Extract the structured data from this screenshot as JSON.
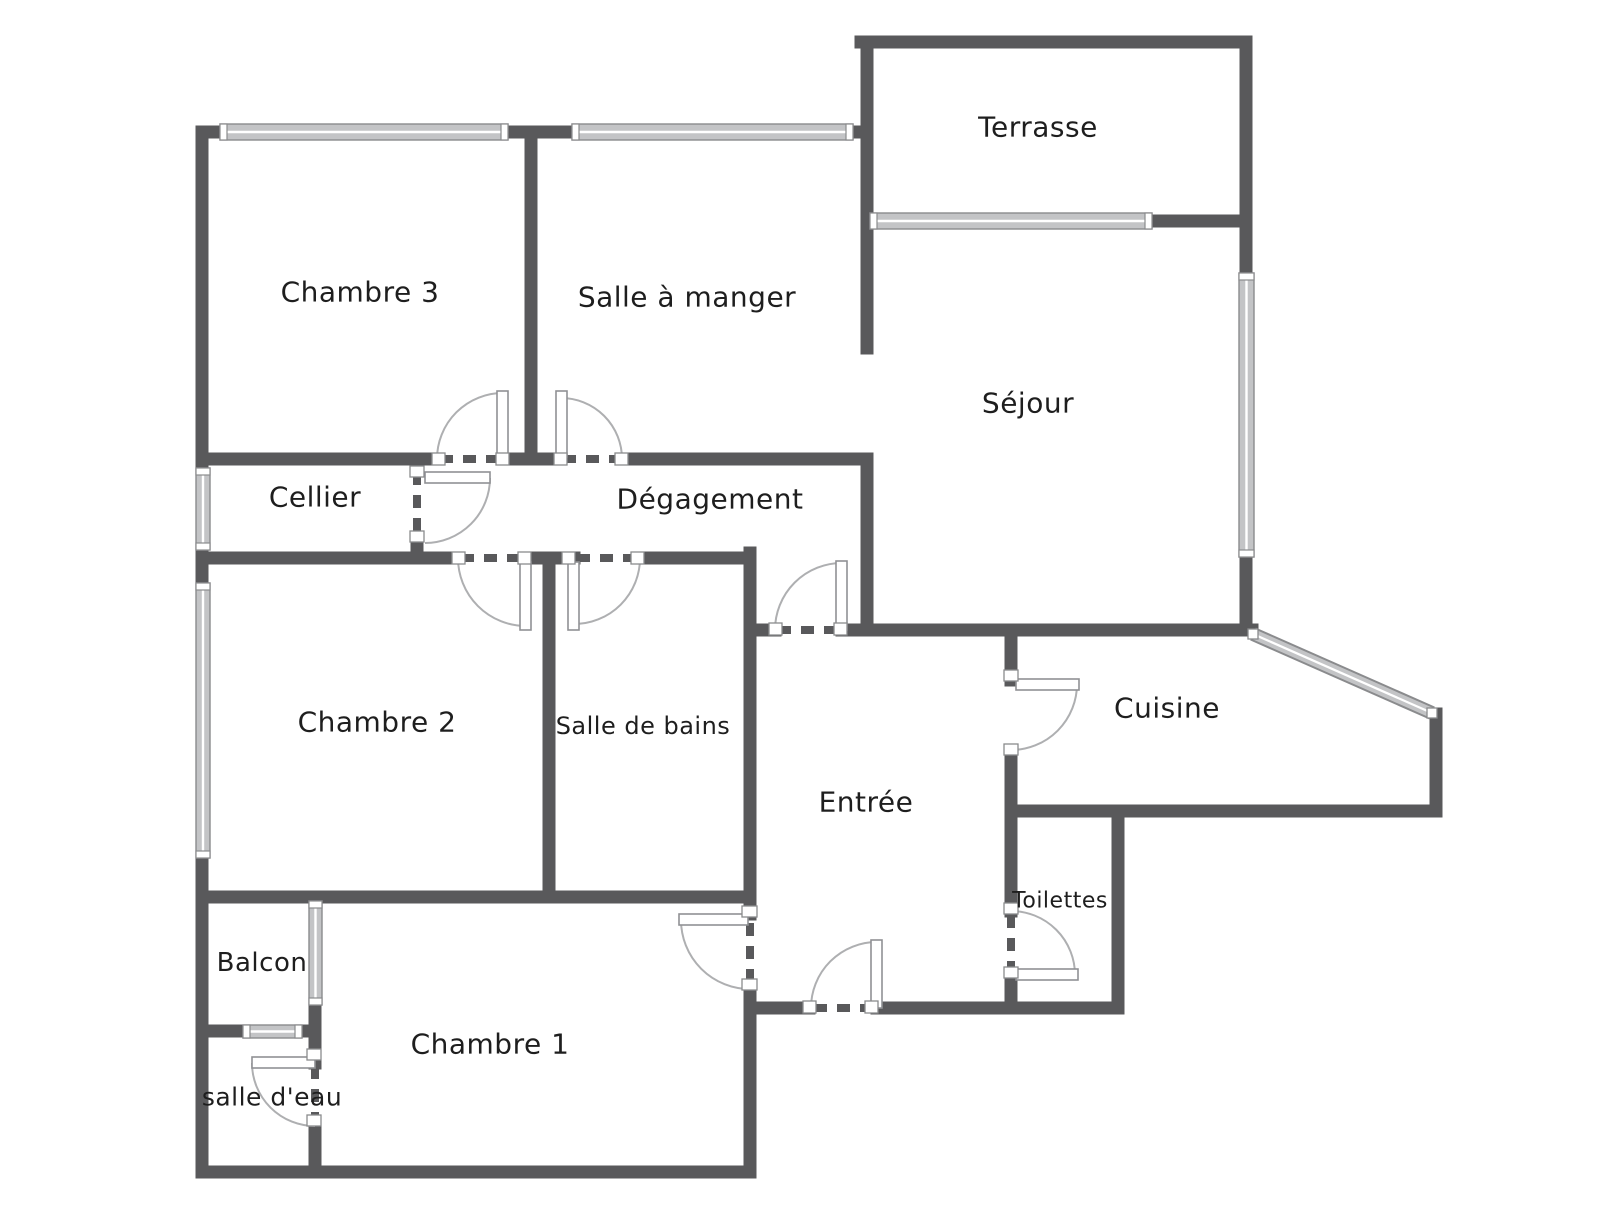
{
  "colors": {
    "background": "#ffffff",
    "wall": "#59595b",
    "window_fill": "#c3c4c6",
    "window_border": "#8a8b8d",
    "leaf_border": "#909194",
    "arc": "#aeafb1",
    "text": "#1e1e1e"
  },
  "rooms": [
    {
      "label": "Terrasse",
      "x": 1038,
      "y": 127,
      "size": 28
    },
    {
      "label": "Chambre 3",
      "x": 360,
      "y": 292,
      "size": 28
    },
    {
      "label": "Salle à manger",
      "x": 687,
      "y": 297,
      "size": 28
    },
    {
      "label": "Séjour",
      "x": 1028,
      "y": 403,
      "size": 28
    },
    {
      "label": "Cellier",
      "x": 315,
      "y": 497,
      "size": 28
    },
    {
      "label": "Dégagement",
      "x": 710,
      "y": 499,
      "size": 28
    },
    {
      "label": "Chambre 2",
      "x": 377,
      "y": 722,
      "size": 28
    },
    {
      "label": "Salle de bains",
      "x": 643,
      "y": 726,
      "size": 24
    },
    {
      "label": "Cuisine",
      "x": 1167,
      "y": 708,
      "size": 28
    },
    {
      "label": "Entrée",
      "x": 866,
      "y": 802,
      "size": 28
    },
    {
      "label": "Toilettes",
      "x": 1060,
      "y": 901,
      "size": 22
    },
    {
      "label": "Balcon",
      "x": 262,
      "y": 963,
      "size": 26
    },
    {
      "label": "Chambre 1",
      "x": 490,
      "y": 1044,
      "size": 28
    },
    {
      "label": "salle d'eau",
      "x": 272,
      "y": 1097,
      "size": 25
    }
  ],
  "floorplan": {
    "wall_thickness": 13,
    "walls": [
      [
        202,
        132,
        202,
        1172
      ],
      [
        202,
        132,
        867,
        132
      ],
      [
        531,
        132,
        531,
        459
      ],
      [
        861,
        42,
        1246,
        42
      ],
      [
        867,
        42,
        867,
        348
      ],
      [
        867,
        221,
        1246,
        221
      ],
      [
        1246,
        42,
        1246,
        630
      ],
      [
        202,
        459,
        437,
        459
      ],
      [
        503,
        459,
        561,
        459
      ],
      [
        622,
        459,
        867,
        459
      ],
      [
        867,
        459,
        867,
        630
      ],
      [
        202,
        558,
        458,
        558
      ],
      [
        526,
        558,
        574,
        558
      ],
      [
        640,
        558,
        750,
        558
      ],
      [
        417,
        545,
        417,
        558
      ],
      [
        549,
        558,
        549,
        897
      ],
      [
        750,
        553,
        750,
        914
      ],
      [
        750,
        989,
        750,
        1172
      ],
      [
        202,
        897,
        750,
        897
      ],
      [
        750,
        630,
        775,
        630
      ],
      [
        842,
        630,
        1252,
        630
      ],
      [
        1011,
        630,
        1011,
        680
      ],
      [
        1011,
        750,
        1011,
        911
      ],
      [
        1011,
        975,
        1011,
        1008
      ],
      [
        1011,
        811,
        1436,
        811
      ],
      [
        1436,
        714,
        1436,
        811
      ],
      [
        750,
        1008,
        809,
        1008
      ],
      [
        877,
        1008,
        1118,
        1008
      ],
      [
        1118,
        811,
        1118,
        1008
      ],
      [
        202,
        1172,
        750,
        1172
      ],
      [
        315,
        1005,
        315,
        1063
      ],
      [
        315,
        1126,
        315,
        1172
      ],
      [
        204,
        1031,
        315,
        1031
      ]
    ],
    "windows": [
      {
        "x": 220,
        "y": 124,
        "w": 288,
        "h": 16,
        "orient": "h"
      },
      {
        "x": 572,
        "y": 124,
        "w": 281,
        "h": 16,
        "orient": "h"
      },
      {
        "x": 870,
        "y": 213,
        "w": 282,
        "h": 16,
        "orient": "h"
      },
      {
        "x": 1239,
        "y": 273,
        "w": 15,
        "h": 284,
        "orient": "v"
      },
      {
        "x": 196,
        "y": 468,
        "w": 14,
        "h": 82,
        "orient": "v"
      },
      {
        "x": 196,
        "y": 583,
        "w": 14,
        "h": 275,
        "orient": "v"
      },
      {
        "x": 309,
        "y": 901,
        "w": 13,
        "h": 104,
        "orient": "v"
      },
      {
        "x": 243,
        "y": 1025,
        "w": 59,
        "h": 13,
        "orient": "h"
      },
      {
        "x1": 1253,
        "y1": 634,
        "x2": 1432,
        "y2": 713
      }
    ],
    "doors": [
      {
        "leaf": [
          497,
          391,
          11,
          66
        ],
        "arc": {
          "cx": 503,
          "cy": 459,
          "r": 66,
          "a0": 180,
          "a1": 270,
          "sweep": 1
        },
        "dash": [
          440,
          459,
          501,
          459
        ],
        "brackets": [
          [
            432,
            453,
            13,
            12
          ],
          [
            496,
            453,
            13,
            12
          ]
        ]
      },
      {
        "leaf": [
          556,
          391,
          11,
          66
        ],
        "arc": {
          "cx": 561,
          "cy": 459,
          "r": 61,
          "a0": 270,
          "a1": 360,
          "sweep": 1
        },
        "dash": [
          563,
          459,
          620,
          459
        ],
        "brackets": [
          [
            554,
            453,
            13,
            12
          ],
          [
            615,
            453,
            13,
            12
          ]
        ]
      },
      {
        "leaf": [
          520,
          562,
          11,
          68
        ],
        "arc": {
          "cx": 526,
          "cy": 558,
          "r": 68,
          "a0": 180,
          "a1": 90,
          "sweep": 0
        },
        "dash": [
          461,
          558,
          523,
          558
        ],
        "brackets": [
          [
            452,
            552,
            13,
            12
          ],
          [
            518,
            552,
            13,
            12
          ]
        ]
      },
      {
        "leaf": [
          568,
          562,
          11,
          68
        ],
        "arc": {
          "cx": 574,
          "cy": 558,
          "r": 66,
          "a0": 90,
          "a1": 0,
          "sweep": 0
        },
        "dash": [
          577,
          558,
          637,
          558
        ],
        "brackets": [
          [
            562,
            552,
            13,
            12
          ],
          [
            631,
            552,
            13,
            12
          ]
        ]
      },
      {
        "leaf": [
          425,
          472,
          65,
          11
        ],
        "arc": {
          "cx": 425,
          "cy": 478,
          "r": 65,
          "a0": 0,
          "a1": 90,
          "sweep": 1
        },
        "dash": [
          417,
          472,
          417,
          541
        ],
        "brackets": [
          [
            410,
            466,
            14,
            11
          ],
          [
            410,
            531,
            14,
            11
          ]
        ]
      },
      {
        "leaf": [
          836,
          561,
          11,
          69
        ],
        "arc": {
          "cx": 842,
          "cy": 630,
          "r": 67,
          "a0": 180,
          "a1": 270,
          "sweep": 1
        },
        "dash": [
          778,
          630,
          840,
          630
        ],
        "brackets": [
          [
            769,
            623,
            13,
            12
          ],
          [
            834,
            623,
            13,
            12
          ]
        ]
      },
      {
        "leaf": [
          1016,
          679,
          63,
          11
        ],
        "arc": {
          "cx": 1011,
          "cy": 684,
          "r": 66,
          "a0": 0,
          "a1": 90,
          "sweep": 1
        },
        "dash": null,
        "brackets": [
          [
            1004,
            670,
            14,
            11
          ],
          [
            1004,
            744,
            14,
            11
          ]
        ]
      },
      {
        "leaf": [
          1016,
          969,
          62,
          11
        ],
        "arc": {
          "cx": 1011,
          "cy": 975,
          "r": 64,
          "a0": 0,
          "a1": 270,
          "sweep": 0
        },
        "dash": [
          1011,
          915,
          1011,
          971
        ],
        "brackets": [
          [
            1004,
            903,
            14,
            11
          ],
          [
            1004,
            967,
            14,
            11
          ]
        ]
      },
      {
        "leaf": [
          679,
          914,
          69,
          11
        ],
        "arc": {
          "cx": 750,
          "cy": 920,
          "r": 69,
          "a0": 180,
          "a1": 90,
          "sweep": 0
        },
        "dash": [
          750,
          923,
          750,
          985
        ],
        "brackets": [
          [
            742,
            906,
            15,
            11
          ],
          [
            742,
            979,
            15,
            11
          ]
        ]
      },
      {
        "leaf": [
          871,
          940,
          11,
          68
        ],
        "arc": {
          "cx": 877,
          "cy": 1008,
          "r": 66,
          "a0": 180,
          "a1": 270,
          "sweep": 1
        },
        "dash": [
          814,
          1008,
          875,
          1008
        ],
        "brackets": [
          [
            803,
            1001,
            13,
            12
          ],
          [
            865,
            1001,
            13,
            12
          ]
        ]
      },
      {
        "leaf": [
          252,
          1057,
          63,
          11
        ],
        "arc": {
          "cx": 315,
          "cy": 1063,
          "r": 63,
          "a0": 180,
          "a1": 90,
          "sweep": 0
        },
        "dash": [
          315,
          1066,
          315,
          1122
        ],
        "brackets": [
          [
            307,
            1049,
            14,
            11
          ],
          [
            307,
            1115,
            14,
            11
          ]
        ]
      }
    ]
  }
}
